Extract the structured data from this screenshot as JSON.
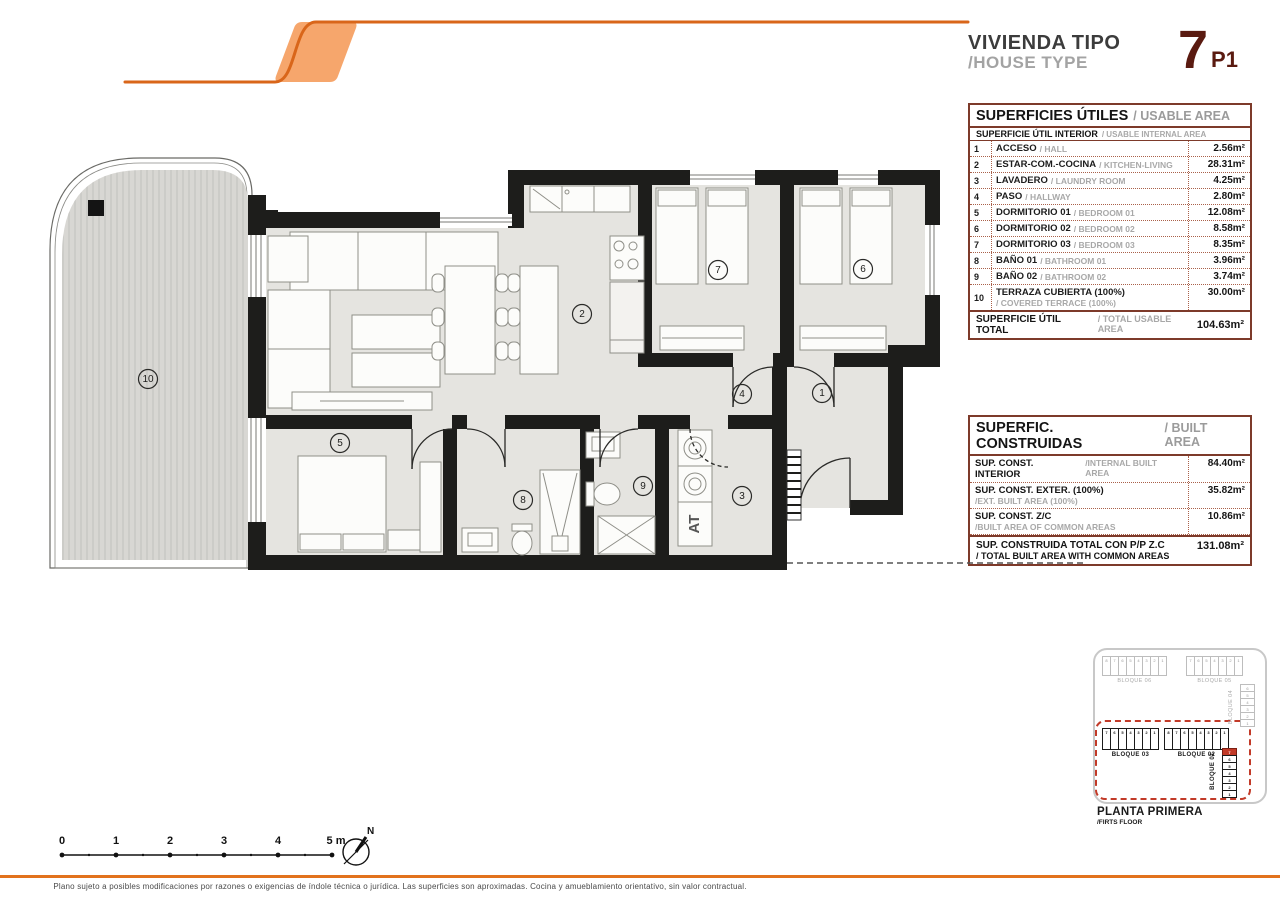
{
  "header": {
    "title_line1": "VIVIENDA TIPO",
    "title_line2": "/HOUSE TYPE",
    "unit_number": "7",
    "unit_floor": "P1"
  },
  "usable_table": {
    "title_es": "SUPERFICIES ÚTILES",
    "title_en": "/ USABLE AREA",
    "subtitle_es": "SUPERFICIE ÚTIL INTERIOR",
    "subtitle_en": "/ USABLE INTERNAL AREA",
    "rows": [
      {
        "num": "1",
        "es": "ACCESO",
        "en": "/ HALL",
        "area": "2.56m²",
        "stack": false
      },
      {
        "num": "2",
        "es": "ESTAR-COM.-COCINA",
        "en": "/ KITCHEN-LIVING",
        "area": "28.31m²",
        "stack": false
      },
      {
        "num": "3",
        "es": "LAVADERO",
        "en": "/ LAUNDRY ROOM",
        "area": "4.25m²",
        "stack": false
      },
      {
        "num": "4",
        "es": "PASO",
        "en": "/ HALLWAY",
        "area": "2.80m²",
        "stack": false
      },
      {
        "num": "5",
        "es": "DORMITORIO 01",
        "en": "/ BEDROOM 01",
        "area": "12.08m²",
        "stack": false
      },
      {
        "num": "6",
        "es": "DORMITORIO 02",
        "en": "/ BEDROOM 02",
        "area": "8.58m²",
        "stack": false
      },
      {
        "num": "7",
        "es": "DORMITORIO 03",
        "en": "/ BEDROOM 03",
        "area": "8.35m²",
        "stack": false
      },
      {
        "num": "8",
        "es": "BAÑO 01",
        "en": "/ BATHROOM 01",
        "area": "3.96m²",
        "stack": false
      },
      {
        "num": "9",
        "es": "BAÑO 02",
        "en": "/ BATHROOM 02",
        "area": "3.74m²",
        "stack": false
      },
      {
        "num": "10",
        "es": "TERRAZA CUBIERTA (100%)",
        "en": "/ COVERED TERRACE (100%)",
        "area": "30.00m²",
        "stack": true
      }
    ],
    "total_es": "SUPERFICIE ÚTIL TOTAL",
    "total_en": "/ TOTAL USABLE AREA",
    "total_area": "104.63m²"
  },
  "built_table": {
    "title_es": "SUPERFIC. CONSTRUIDAS",
    "title_en": "/ BUILT AREA",
    "rows": [
      {
        "es": "SUP. CONST. INTERIOR",
        "en": "/INTERNAL BUILT AREA",
        "area": "84.40m²",
        "inline": true
      },
      {
        "es": "SUP. CONST. EXTER. (100%)",
        "en": "/EXT. BUILT AREA (100%)",
        "area": "35.82m²",
        "inline": false
      },
      {
        "es": "SUP. CONST. Z/C",
        "en": "/BUILT AREA OF COMMON AREAS",
        "area": "10.86m²",
        "inline": false
      }
    ],
    "total_es": "SUP. CONSTRUIDA TOTAL CON P/P Z.C",
    "total_en": "/ TOTAL BUILT AREA WITH COMMON AREAS",
    "total_area": "131.08m²"
  },
  "floorplan": {
    "at_label": "AT",
    "rooms": [
      {
        "n": "1",
        "x": 822,
        "y": 253
      },
      {
        "n": "2",
        "x": 582,
        "y": 174
      },
      {
        "n": "3",
        "x": 742,
        "y": 356
      },
      {
        "n": "4",
        "x": 742,
        "y": 254
      },
      {
        "n": "5",
        "x": 340,
        "y": 303
      },
      {
        "n": "6",
        "x": 863,
        "y": 129
      },
      {
        "n": "7",
        "x": 718,
        "y": 130
      },
      {
        "n": "8",
        "x": 523,
        "y": 360
      },
      {
        "n": "9",
        "x": 643,
        "y": 346
      },
      {
        "n": "10",
        "x": 148,
        "y": 239
      }
    ]
  },
  "scalebar": {
    "labels": [
      "0",
      "1",
      "2",
      "3",
      "4",
      "5 m"
    ],
    "north": "N"
  },
  "keyplan": {
    "blocks": [
      {
        "id": "06",
        "label": "BLOQUE 06",
        "units": [
          "8",
          "7",
          "6",
          "5",
          "4",
          "3",
          "2",
          "1"
        ],
        "variant": "light",
        "orient": "h"
      },
      {
        "id": "05",
        "label": "BLOQUE 05",
        "units": [
          "7",
          "6",
          "5",
          "4",
          "3",
          "2",
          "1"
        ],
        "variant": "light",
        "orient": "h"
      },
      {
        "id": "04",
        "label": "BLOQUE 04",
        "units": [
          "6",
          "5",
          "4",
          "3",
          "2",
          "1"
        ],
        "variant": "light",
        "orient": "v"
      },
      {
        "id": "03",
        "label": "BLOQUE 03",
        "units": [
          "7",
          "6",
          "5",
          "4",
          "3",
          "2",
          "1"
        ],
        "variant": "dark",
        "orient": "h"
      },
      {
        "id": "02",
        "label": "BLOQUE 02",
        "units": [
          "8",
          "7",
          "6",
          "5",
          "4",
          "3",
          "2",
          "1"
        ],
        "variant": "dark",
        "orient": "h"
      },
      {
        "id": "01",
        "label": "BLOQUE 01",
        "units": [
          "7",
          "6",
          "5",
          "4",
          "3",
          "2",
          "1"
        ],
        "variant": "dark",
        "orient": "v",
        "highlight": "7"
      }
    ],
    "caption_line1": "PLANTA PRIMERA",
    "caption_line2": "/FIRTS FLOOR"
  },
  "footer": {
    "disclaimer": "Plano sujeto a posibles modificaciones por razones o exigencias de índole técnica o jurídica. Las superficies son aproximadas. Cocina y amueblamiento orientativo, sin valor contractual."
  }
}
